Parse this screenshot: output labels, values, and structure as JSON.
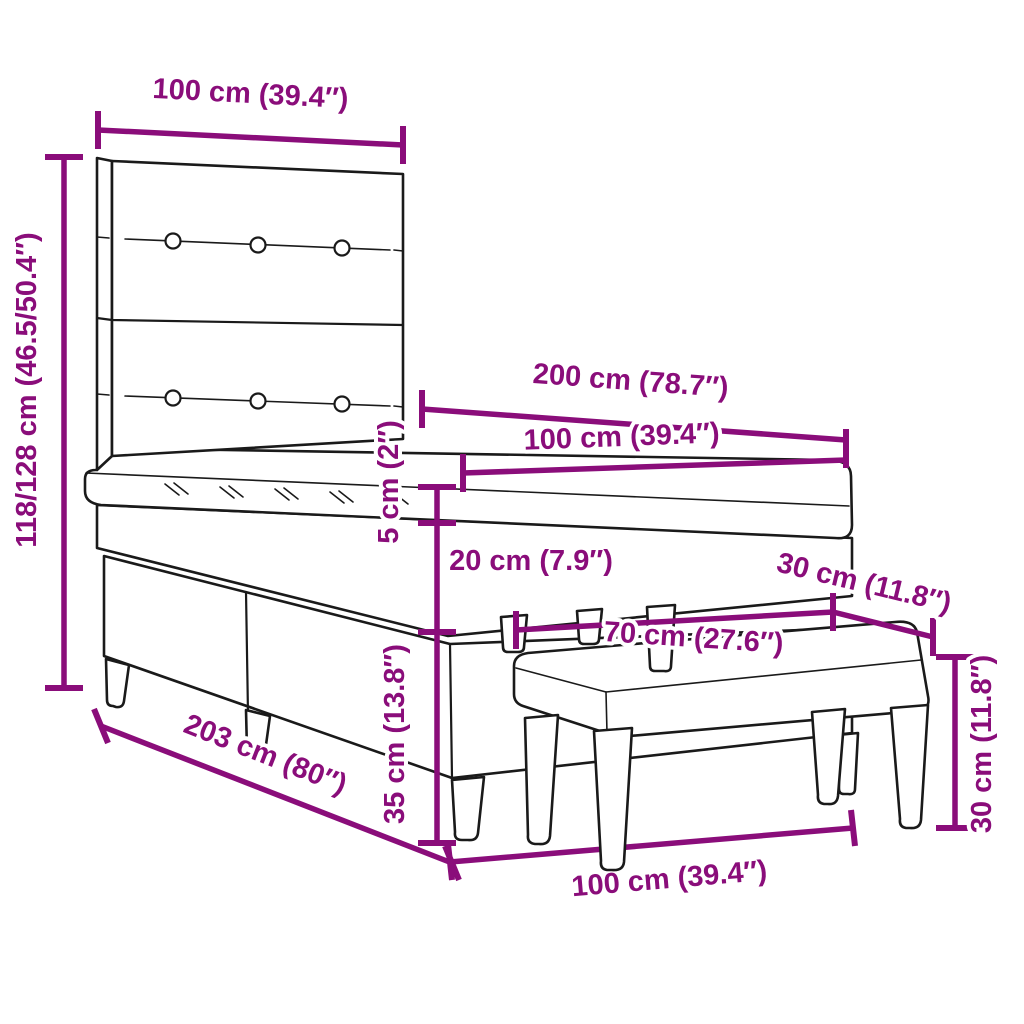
{
  "colors": {
    "accent": "#8A0D7A",
    "ink": "#1A1A1A",
    "background": "#FFFFFF"
  },
  "diagram": {
    "type": "furniture-dimension-diagram",
    "subject": "box-spring-bed-with-headboard-topper-and-bench"
  },
  "labels": {
    "headboard_width": "100 cm (39.4″)",
    "total_height": "118/128 cm (46.5/50.4″)",
    "bed_length": "200 cm (78.7″)",
    "bed_width": "100 cm (39.4″)",
    "topper_height": "5 cm (2″)",
    "mattress_height": "20 cm (7.9″)",
    "bench_depth": "30 cm (11.8″)",
    "bench_length": "70 cm (27.6″)",
    "frame_length": "203 cm (80″)",
    "base_height": "35 cm (13.8″)",
    "foot_end_width": "100 cm (39.4″)",
    "bench_height": "30 cm (11.8″)"
  }
}
